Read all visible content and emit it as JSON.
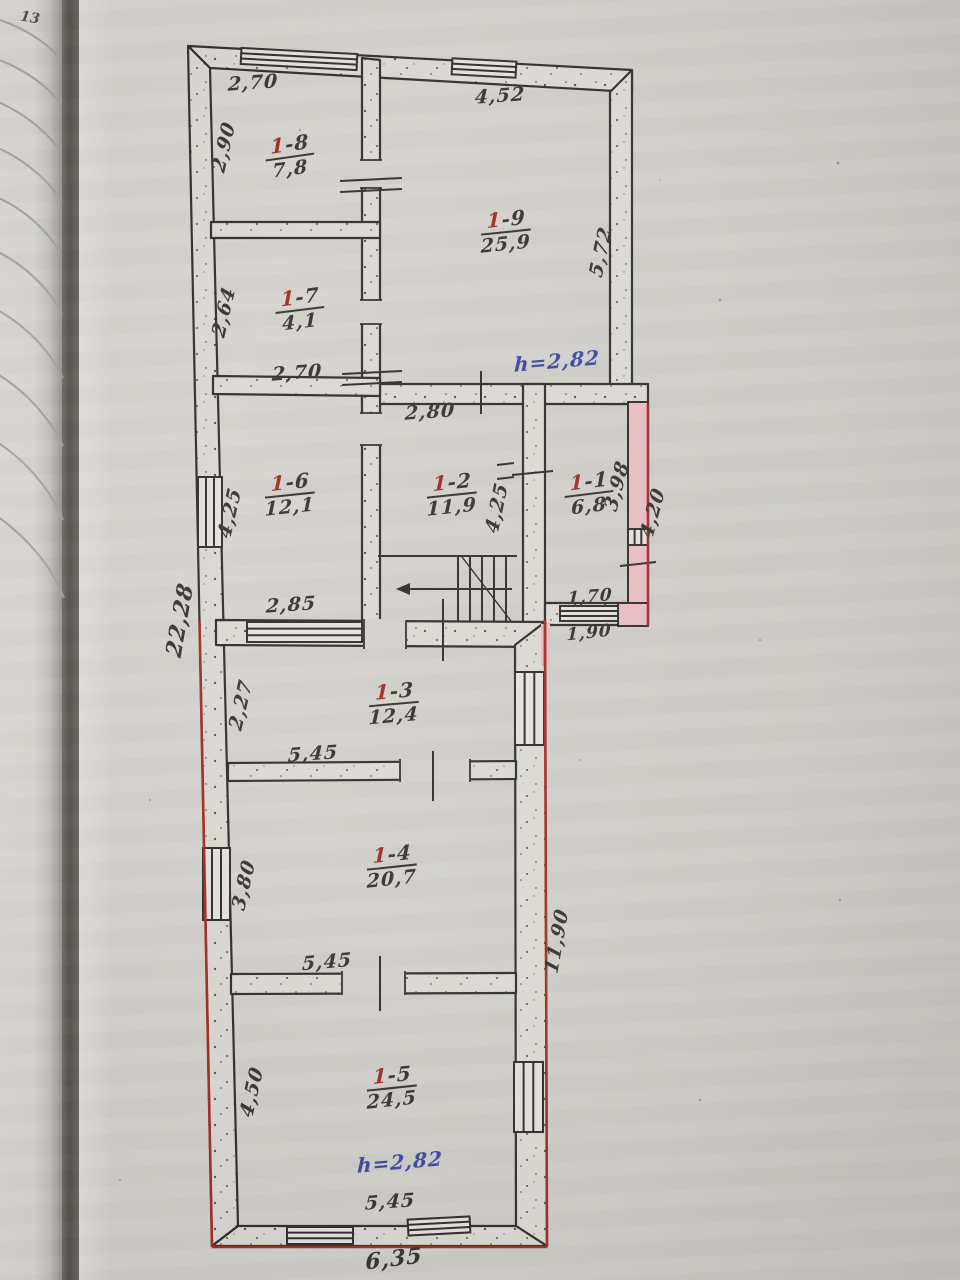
{
  "page": {
    "number": "13"
  },
  "colors": {
    "red_ink": "#9e2a21",
    "blue_ink": "#3a47a0",
    "black_ink": "#35332e",
    "red_line": "#a02c24",
    "pink_wall": "#e7bcc0"
  },
  "plan": {
    "rooms": {
      "r1": {
        "num": "1-1",
        "area": "6,8"
      },
      "r2": {
        "num": "1-2",
        "area": "11,9"
      },
      "r3": {
        "num": "1-3",
        "area": "12,4"
      },
      "r4": {
        "num": "1-4",
        "area": "20,7"
      },
      "r5": {
        "num": "1-5",
        "area": "24,5"
      },
      "r6": {
        "num": "1-6",
        "area": "12,1"
      },
      "r7": {
        "num": "1-7",
        "area": "4,1"
      },
      "r8": {
        "num": "1-8",
        "area": "7,8"
      },
      "r9": {
        "num": "1-9",
        "area": "25,9"
      }
    },
    "dimensions": {
      "r8_top": "2,70",
      "r8_left": "2,90",
      "r9_top": "4,52",
      "r9_right": "5,72",
      "r7_left": "2,64",
      "r7_bottom": "2,70",
      "r6_left": "4,25",
      "r6_bottom": "2,85",
      "r2_top": "2,80",
      "r2_right": "4,25",
      "r1_right_inner": "3,98",
      "r1_right_outer": "4,20",
      "r1_bottom_inner": "1,70",
      "r1_bottom_outer": "1,90",
      "r3_left": "2,27",
      "r3_bottom": "5,45",
      "r4_left": "3,80",
      "r4_bottom": "5,45",
      "r5_left": "4,50",
      "r5_bottom": "5,45",
      "overall_left": "22,28",
      "overall_right": "11,90",
      "overall_bottom": "6,35"
    },
    "annotations": {
      "height_note_upper": "h=2,82",
      "height_note_lower": "h=2,82"
    }
  }
}
